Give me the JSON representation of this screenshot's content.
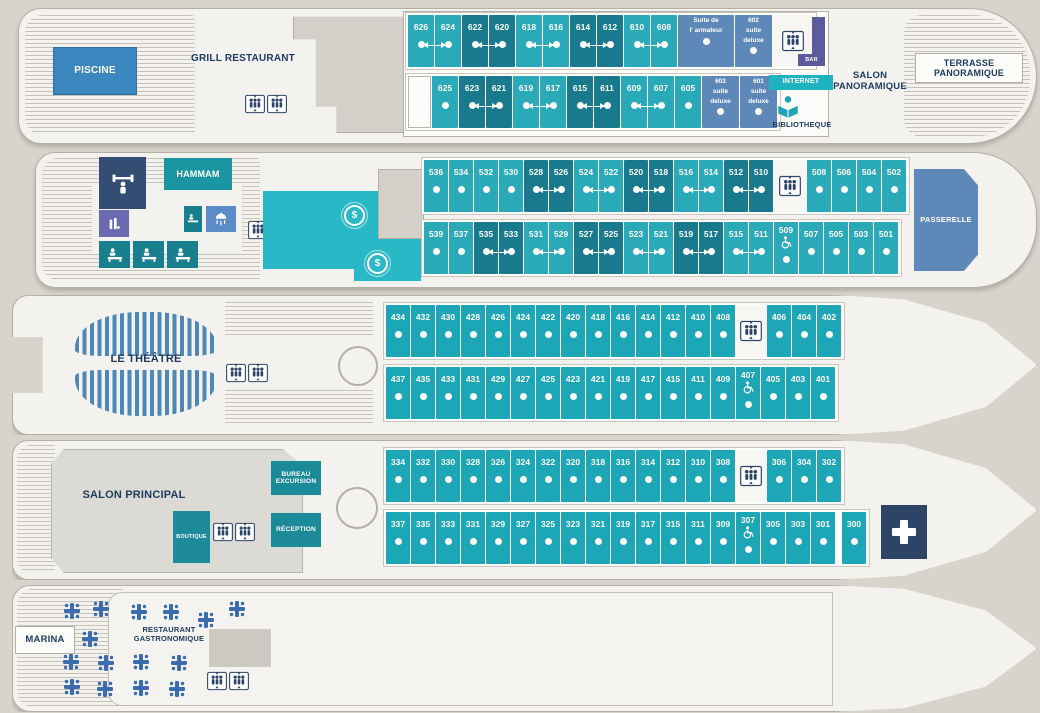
{
  "title": "Plan des ponts du navire",
  "icons": {
    "dollar": "$"
  },
  "colors": {
    "cabin_light": "#2aa9b9",
    "cabin_dark": "#187a8c",
    "cabin_medium": "#1ca6b6",
    "suite_blue": "#5e88b8",
    "pool_blue": "#3d87c0",
    "navy": "#2e4467",
    "teal_area": "#29b9c6",
    "seats_blue": "#4d87b8",
    "bar_purple": "#5d5b9e"
  },
  "deck6": {
    "labels": {
      "piscine": "PISCINE",
      "grill": "GRILL RESTAURANT",
      "salon": "SALON PANORAMIQUE",
      "terrasse": "TERRASSE PANORAMIQUE",
      "bar": "BAR",
      "internet": "INTERNET",
      "bibliotheque": "BIBLIOTHEQUE"
    },
    "rows": {
      "top": {
        "cellw": 26,
        "cells": [
          {
            "n": "626",
            "c": "l",
            "p": 1
          },
          {
            "n": "624",
            "c": "l"
          },
          {
            "n": "622",
            "c": "d",
            "p": 1
          },
          {
            "n": "620",
            "c": "d"
          },
          {
            "n": "618",
            "c": "l",
            "p": 1
          },
          {
            "n": "616",
            "c": "l"
          },
          {
            "n": "614",
            "c": "d",
            "p": 1
          },
          {
            "n": "612",
            "c": "d"
          },
          {
            "n": "610",
            "c": "l",
            "p": 1
          },
          {
            "n": "608",
            "c": "l"
          },
          {
            "t": "suite",
            "w": 56,
            "lines": [
              "Suite de",
              "l' armateur"
            ]
          },
          {
            "t": "suite",
            "w": 37,
            "lines": [
              "602",
              "suite",
              "deluxe"
            ]
          },
          {
            "t": "e",
            "w": 40
          }
        ]
      },
      "bottom": {
        "cellw": 26,
        "cells": [
          {
            "t": "s",
            "w": 23
          },
          {
            "n": "625",
            "c": "l"
          },
          {
            "n": "623",
            "c": "d",
            "p": 1
          },
          {
            "n": "621",
            "c": "d"
          },
          {
            "n": "619",
            "c": "l",
            "p": 1
          },
          {
            "n": "617",
            "c": "l"
          },
          {
            "n": "615",
            "c": "d",
            "p": 1
          },
          {
            "n": "611",
            "c": "d"
          },
          {
            "n": "609",
            "c": "l",
            "p": 1
          },
          {
            "n": "607",
            "c": "l"
          },
          {
            "n": "605",
            "c": "l"
          },
          {
            "t": "suite",
            "w": 37,
            "lines": [
              "603",
              "suite",
              "deluxe"
            ]
          },
          {
            "t": "suite",
            "w": 37,
            "lines": [
              "601",
              "suite",
              "deluxe"
            ]
          }
        ]
      }
    }
  },
  "deck5": {
    "labels": {
      "hammam": "HAMMAM",
      "passerelle": "PASSERELLE"
    },
    "rows": {
      "top": {
        "cellw": 24,
        "cells": [
          {
            "n": "536",
            "c": "l"
          },
          {
            "n": "534",
            "c": "l"
          },
          {
            "n": "532",
            "c": "l"
          },
          {
            "n": "530",
            "c": "l"
          },
          {
            "n": "528",
            "c": "d",
            "p": 1
          },
          {
            "n": "526",
            "c": "d"
          },
          {
            "n": "524",
            "c": "l",
            "p": 1
          },
          {
            "n": "522",
            "c": "l"
          },
          {
            "n": "520",
            "c": "d",
            "p": 1
          },
          {
            "n": "518",
            "c": "d"
          },
          {
            "n": "516",
            "c": "l",
            "p": 1
          },
          {
            "n": "514",
            "c": "l"
          },
          {
            "n": "512",
            "c": "d",
            "p": 1
          },
          {
            "n": "510",
            "c": "d"
          },
          {
            "t": "e",
            "w": 32
          },
          {
            "n": "508",
            "c": "l"
          },
          {
            "n": "506",
            "c": "l"
          },
          {
            "n": "504",
            "c": "l"
          },
          {
            "n": "502",
            "c": "l"
          }
        ]
      },
      "bottom": {
        "cellw": 24,
        "cells": [
          {
            "n": "539",
            "c": "l"
          },
          {
            "n": "537",
            "c": "l"
          },
          {
            "n": "535",
            "c": "d",
            "p": 1
          },
          {
            "n": "533",
            "c": "d"
          },
          {
            "n": "531",
            "c": "l",
            "p": 1
          },
          {
            "n": "529",
            "c": "l"
          },
          {
            "n": "527",
            "c": "d",
            "p": 1
          },
          {
            "n": "525",
            "c": "d"
          },
          {
            "n": "523",
            "c": "l",
            "p": 1
          },
          {
            "n": "521",
            "c": "l"
          },
          {
            "n": "519",
            "c": "d",
            "p": 1
          },
          {
            "n": "517",
            "c": "d"
          },
          {
            "n": "515",
            "c": "l",
            "p": 1
          },
          {
            "n": "511",
            "c": "l"
          },
          {
            "n": "509",
            "c": "l",
            "acc": true
          },
          {
            "n": "507",
            "c": "l"
          },
          {
            "n": "505",
            "c": "l"
          },
          {
            "n": "503",
            "c": "l"
          },
          {
            "n": "501",
            "c": "l"
          }
        ]
      }
    }
  },
  "deck4": {
    "labels": {
      "theatre": "LE THÉÂTRE"
    },
    "rows": {
      "top": {
        "cellw": 24,
        "cells": [
          {
            "n": "434",
            "c": "m"
          },
          {
            "n": "432",
            "c": "m"
          },
          {
            "n": "430",
            "c": "m"
          },
          {
            "n": "428",
            "c": "m"
          },
          {
            "n": "426",
            "c": "m"
          },
          {
            "n": "424",
            "c": "m"
          },
          {
            "n": "422",
            "c": "m"
          },
          {
            "n": "420",
            "c": "m"
          },
          {
            "n": "418",
            "c": "m"
          },
          {
            "n": "416",
            "c": "m"
          },
          {
            "n": "414",
            "c": "m"
          },
          {
            "n": "412",
            "c": "m"
          },
          {
            "n": "410",
            "c": "m"
          },
          {
            "n": "408",
            "c": "m"
          },
          {
            "t": "e",
            "w": 30
          },
          {
            "n": "406",
            "c": "m"
          },
          {
            "n": "404",
            "c": "m"
          },
          {
            "n": "402",
            "c": "m"
          }
        ]
      },
      "bottom": {
        "cellw": 24,
        "cells": [
          {
            "n": "437",
            "c": "m"
          },
          {
            "n": "435",
            "c": "m"
          },
          {
            "n": "433",
            "c": "m"
          },
          {
            "n": "431",
            "c": "m"
          },
          {
            "n": "429",
            "c": "m"
          },
          {
            "n": "427",
            "c": "m"
          },
          {
            "n": "425",
            "c": "m"
          },
          {
            "n": "423",
            "c": "m"
          },
          {
            "n": "421",
            "c": "m"
          },
          {
            "n": "419",
            "c": "m"
          },
          {
            "n": "417",
            "c": "m"
          },
          {
            "n": "415",
            "c": "m"
          },
          {
            "n": "411",
            "c": "m"
          },
          {
            "n": "409",
            "c": "m"
          },
          {
            "n": "407",
            "c": "m",
            "acc": true
          },
          {
            "n": "405",
            "c": "m"
          },
          {
            "n": "403",
            "c": "m"
          },
          {
            "n": "401",
            "c": "m"
          }
        ]
      }
    }
  },
  "deck3": {
    "labels": {
      "salon": "SALON PRINCIPAL",
      "bureau": "BUREAU EXCURSION",
      "boutique": "BOUTIQUE",
      "reception": "RÉCEPTION"
    },
    "rows": {
      "top": {
        "cellw": 24,
        "cells": [
          {
            "n": "334",
            "c": "m"
          },
          {
            "n": "332",
            "c": "m"
          },
          {
            "n": "330",
            "c": "m"
          },
          {
            "n": "328",
            "c": "m"
          },
          {
            "n": "326",
            "c": "m"
          },
          {
            "n": "324",
            "c": "m"
          },
          {
            "n": "322",
            "c": "m"
          },
          {
            "n": "320",
            "c": "m"
          },
          {
            "n": "318",
            "c": "m"
          },
          {
            "n": "316",
            "c": "m"
          },
          {
            "n": "314",
            "c": "m"
          },
          {
            "n": "312",
            "c": "m"
          },
          {
            "n": "310",
            "c": "m"
          },
          {
            "n": "308",
            "c": "m"
          },
          {
            "t": "e",
            "w": 30
          },
          {
            "n": "306",
            "c": "m"
          },
          {
            "n": "304",
            "c": "m"
          },
          {
            "n": "302",
            "c": "m"
          }
        ]
      },
      "bottom": {
        "cellw": 24,
        "cells": [
          {
            "n": "337",
            "c": "m"
          },
          {
            "n": "335",
            "c": "m"
          },
          {
            "n": "333",
            "c": "m"
          },
          {
            "n": "331",
            "c": "m"
          },
          {
            "n": "329",
            "c": "m"
          },
          {
            "n": "327",
            "c": "m"
          },
          {
            "n": "325",
            "c": "m"
          },
          {
            "n": "323",
            "c": "m"
          },
          {
            "n": "321",
            "c": "m"
          },
          {
            "n": "319",
            "c": "m"
          },
          {
            "n": "317",
            "c": "m"
          },
          {
            "n": "315",
            "c": "m"
          },
          {
            "n": "311",
            "c": "m"
          },
          {
            "n": "309",
            "c": "m"
          },
          {
            "n": "307",
            "c": "m",
            "acc": true
          },
          {
            "n": "305",
            "c": "m"
          },
          {
            "n": "303",
            "c": "m"
          },
          {
            "n": "301",
            "c": "m"
          },
          {
            "t": "g",
            "w": 5
          },
          {
            "n": "300",
            "c": "m"
          }
        ]
      }
    }
  },
  "deck2": {
    "labels": {
      "marina": "MARINA",
      "restaurant": "RESTAURANT GASTRONOMIQUE"
    },
    "tables": [
      [
        59,
        25
      ],
      [
        88,
        23
      ],
      [
        126,
        26
      ],
      [
        158,
        26
      ],
      [
        193,
        34
      ],
      [
        224,
        23
      ],
      [
        77,
        53
      ],
      [
        58,
        76
      ],
      [
        93,
        77
      ],
      [
        128,
        76
      ],
      [
        166,
        77
      ],
      [
        59,
        101
      ],
      [
        92,
        103
      ],
      [
        128,
        102
      ],
      [
        164,
        103
      ]
    ]
  }
}
